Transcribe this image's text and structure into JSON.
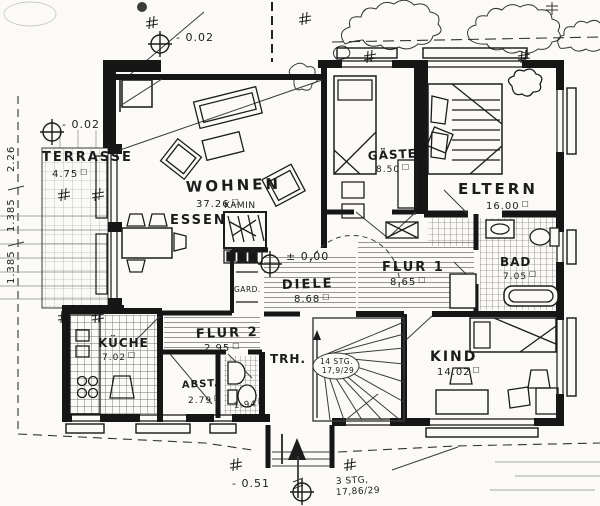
{
  "units": {
    "m2": "□"
  },
  "rooms": {
    "terrasse": {
      "label": "TERRASSE",
      "area": "4.75"
    },
    "wohnen": {
      "label": "WOHNEN",
      "area": "37.26"
    },
    "essen": {
      "label": "ESSEN"
    },
    "kamin": {
      "label": "KAMIN"
    },
    "gaeste": {
      "label": "GÄSTE",
      "area": "8.50"
    },
    "eltern": {
      "label": "ELTERN",
      "area": "16.00"
    },
    "bad": {
      "label": "BAD",
      "area": "7.05"
    },
    "flur1": {
      "label": "FLUR 1",
      "area": "8.65"
    },
    "diele": {
      "label": "DIELE",
      "area": "8.68"
    },
    "gard": {
      "label": "GARD."
    },
    "flur2": {
      "label": "FLUR 2",
      "area": "2.95"
    },
    "kueche": {
      "label": "KÜCHE",
      "area": "7.02"
    },
    "abst": {
      "label": "ABST.",
      "area": "2.79"
    },
    "wc": {
      "area": "1.94"
    },
    "trh": {
      "label": "TRH."
    },
    "kind": {
      "label": "KIND",
      "area": "14.02"
    }
  },
  "levels": {
    "upper": "- 0.02",
    "terrace": "- 0.02",
    "entry": "± 0.00",
    "outside": "- 0.51"
  },
  "stairs": {
    "main_line1": "14 STG.",
    "main_line2": "17,9/29",
    "entry_line1": "3 STG,",
    "entry_line2": "17,86/29"
  },
  "dims": {
    "d1": "2.26",
    "d2": "1.385",
    "d3": "1.385"
  }
}
